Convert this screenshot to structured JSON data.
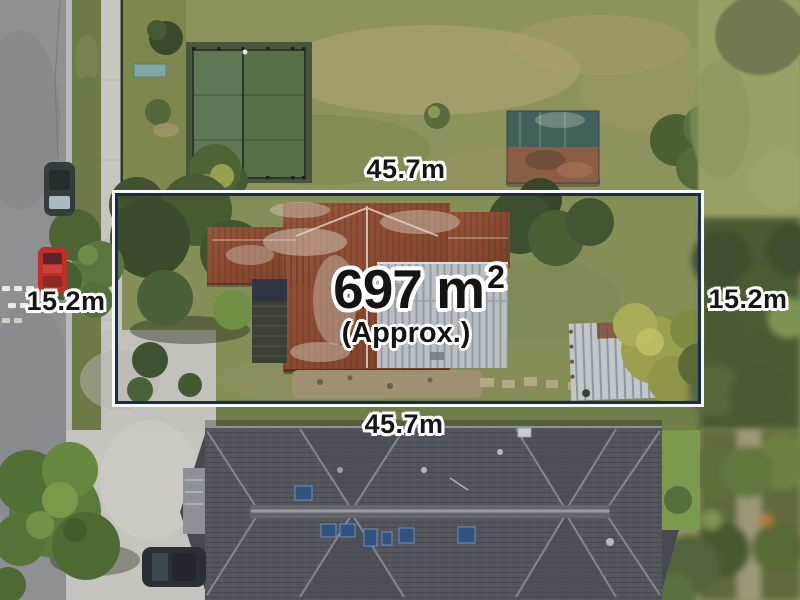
{
  "annotations": {
    "top_width": "45.7m",
    "bottom_width": "45.7m",
    "left_depth": "15.2m",
    "right_depth": "15.2m",
    "area_value": "697 m",
    "area_exponent": "2",
    "area_qualifier": "(Approx.)"
  },
  "colors": {
    "boundary_line": "#182c50",
    "boundary_halo": "#ffffff",
    "label_text": "#161616",
    "label_halo": "#ffffff"
  }
}
